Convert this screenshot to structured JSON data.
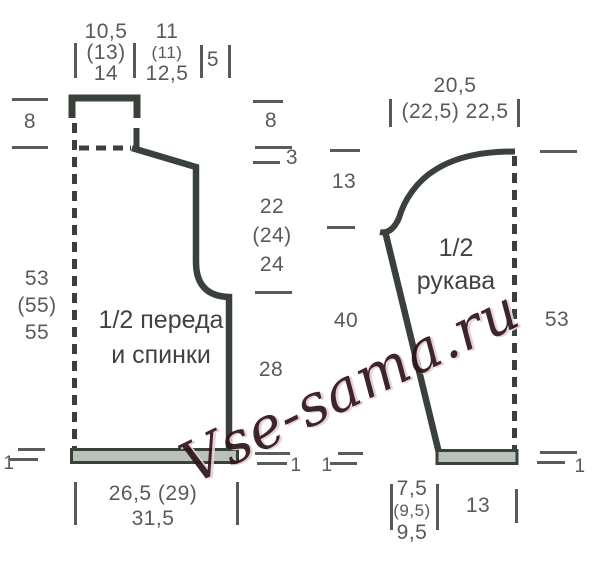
{
  "watermark": {
    "text": "Vse-sama.ru"
  },
  "front_back": {
    "title_line1": "1/2 переда",
    "title_line2": "и спинки",
    "shoulder_bar_width": {
      "v1": "10,5",
      "v2": "(13)",
      "v3": "14"
    },
    "neck_width": {
      "v1": "11",
      "v2": "(11)",
      "v3": "12,5"
    },
    "armhole_width": "5",
    "neckband_height_left": "8",
    "neckband_height_mid": "8",
    "shoulder_slope": "3",
    "armhole_depth": {
      "v1": "22",
      "v2": "(24)",
      "v3": "24"
    },
    "side_seam_length": "28",
    "total_length": {
      "v1": "53",
      "v2": "(55)",
      "v3": "55"
    },
    "rib_left": "1",
    "rib_right": "1",
    "hem_width_line1": "26,5 (29)",
    "hem_width_line2": "31,5"
  },
  "sleeve": {
    "title_line1": "1/2",
    "title_line2": "рукава",
    "top_width_line1": "20,5",
    "top_width_line2": "(22,5) 22,5",
    "cap_height": "13",
    "underarm_length": "40",
    "total_length": "53",
    "rib_left": "1",
    "rib_right": "1",
    "slant_width": {
      "v1": "7,5",
      "v2": "(9,5)",
      "v3": "9,5"
    },
    "cuff_width": "13"
  },
  "colors": {
    "background": "#ffffff",
    "outline": "#3a403a",
    "measurement_text": "#565b56",
    "tick": "#585d58",
    "hem_fill": "#b9c2b9",
    "watermark": "#2d171c"
  }
}
